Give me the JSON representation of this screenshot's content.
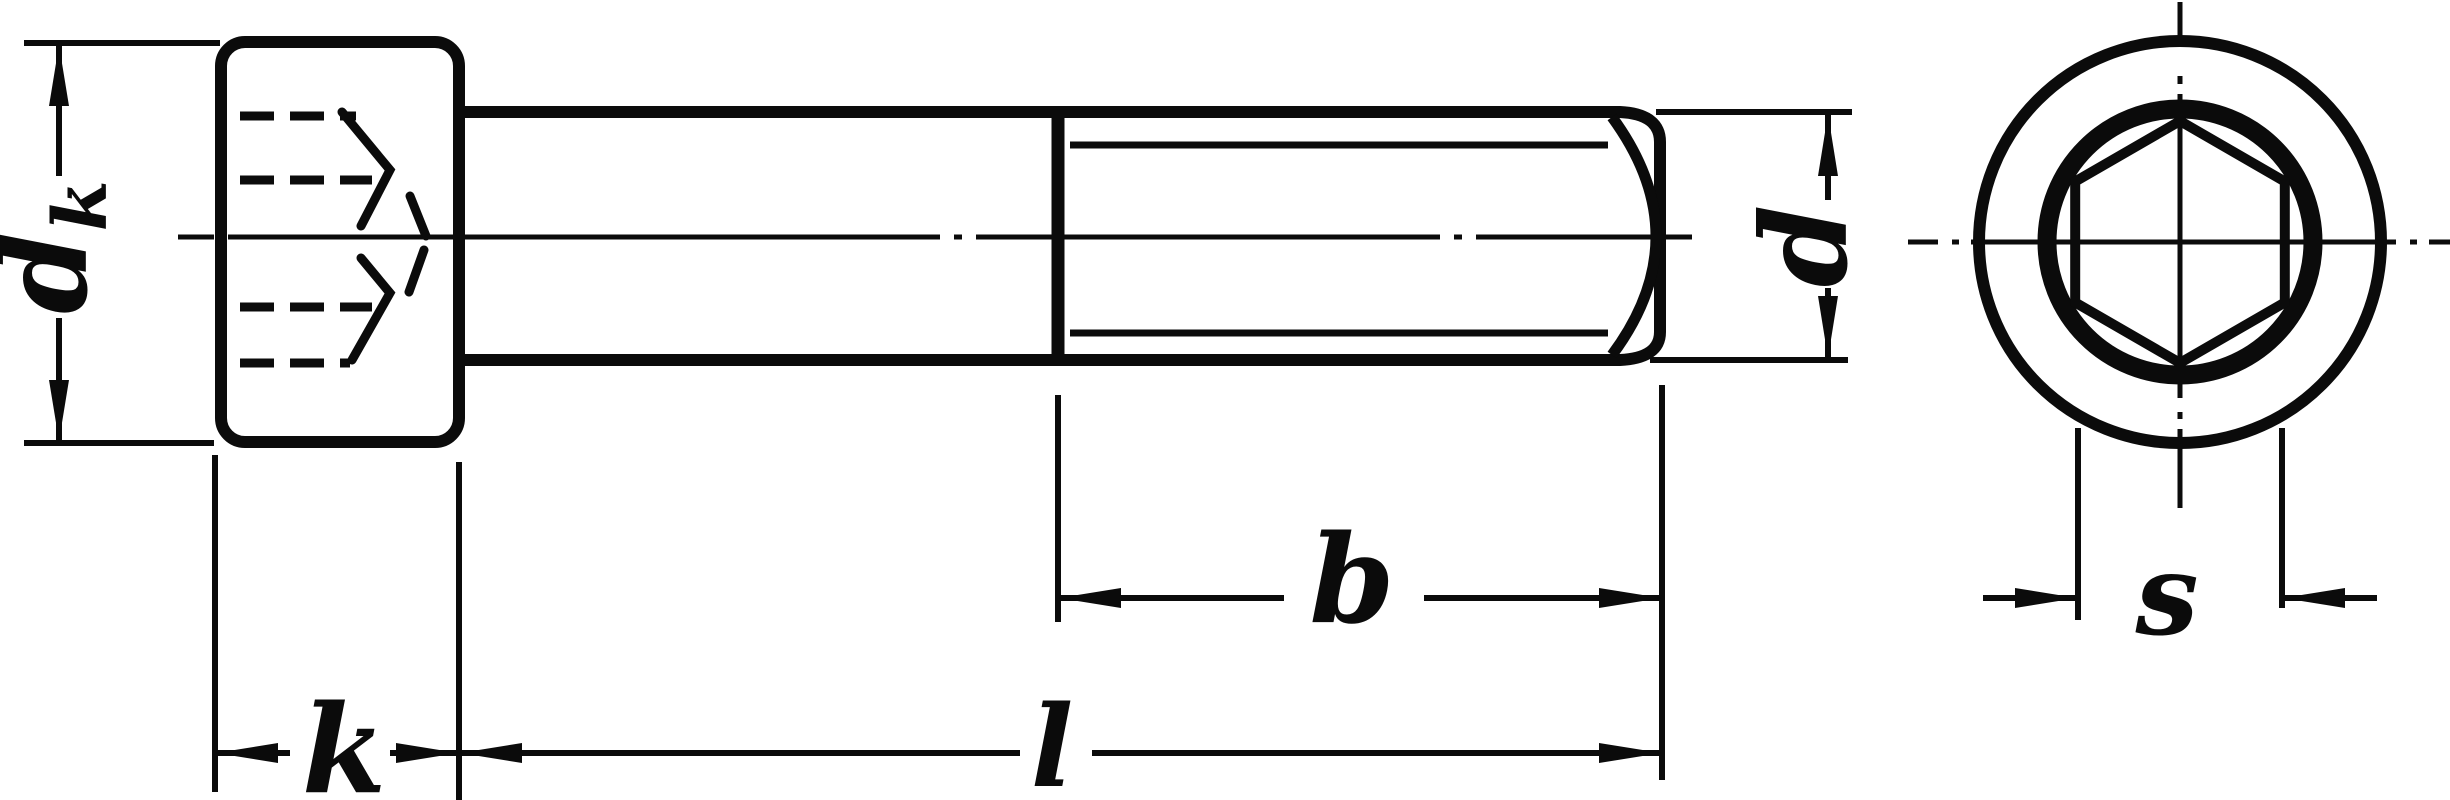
{
  "drawing": {
    "background_color": "#ffffff",
    "ink_color": "#0b0b0b",
    "labels": {
      "head_diameter_main": "d",
      "head_diameter_sub": "k",
      "shank_diameter": "d",
      "thread_length": "b",
      "total_length": "l",
      "head_height": "k",
      "socket_width_across_flats": "s"
    }
  }
}
